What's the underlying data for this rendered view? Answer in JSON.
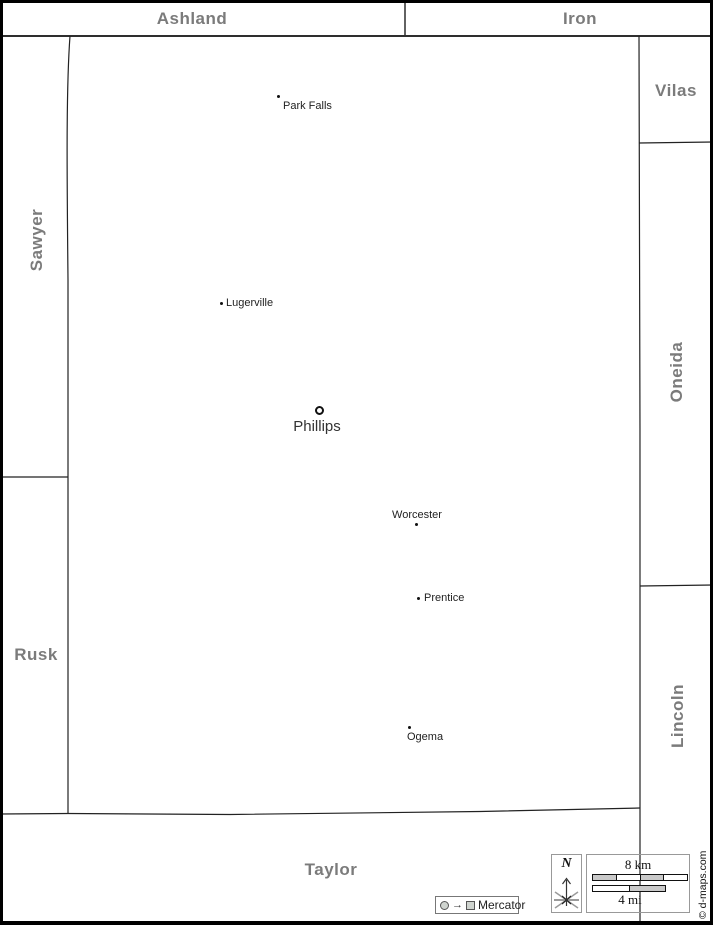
{
  "counties": {
    "ashland": "Ashland",
    "iron": "Iron",
    "sawyer": "Sawyer",
    "vilas": "Vilas",
    "oneida": "Oneida",
    "rusk": "Rusk",
    "lincoln": "Lincoln",
    "taylor": "Taylor"
  },
  "county_seat": {
    "name": "Phillips"
  },
  "towns": {
    "park_falls": "Park Falls",
    "lugerville": "Lugerville",
    "worcester": "Worcester",
    "prentice": "Prentice",
    "ogema": "Ogema"
  },
  "scale_bar": {
    "km_label": "8 km",
    "mi_label": "4 mi"
  },
  "compass": {
    "north_label": "N"
  },
  "projection_legend": {
    "label": "Mercator"
  },
  "credit": "© d-maps.com",
  "colors": {
    "county_label": "#7b7b7b",
    "town_label": "#1f1f1f",
    "boundary_line": "#222222",
    "scale_fill": "#c9c9c9",
    "frame": "#000000"
  }
}
